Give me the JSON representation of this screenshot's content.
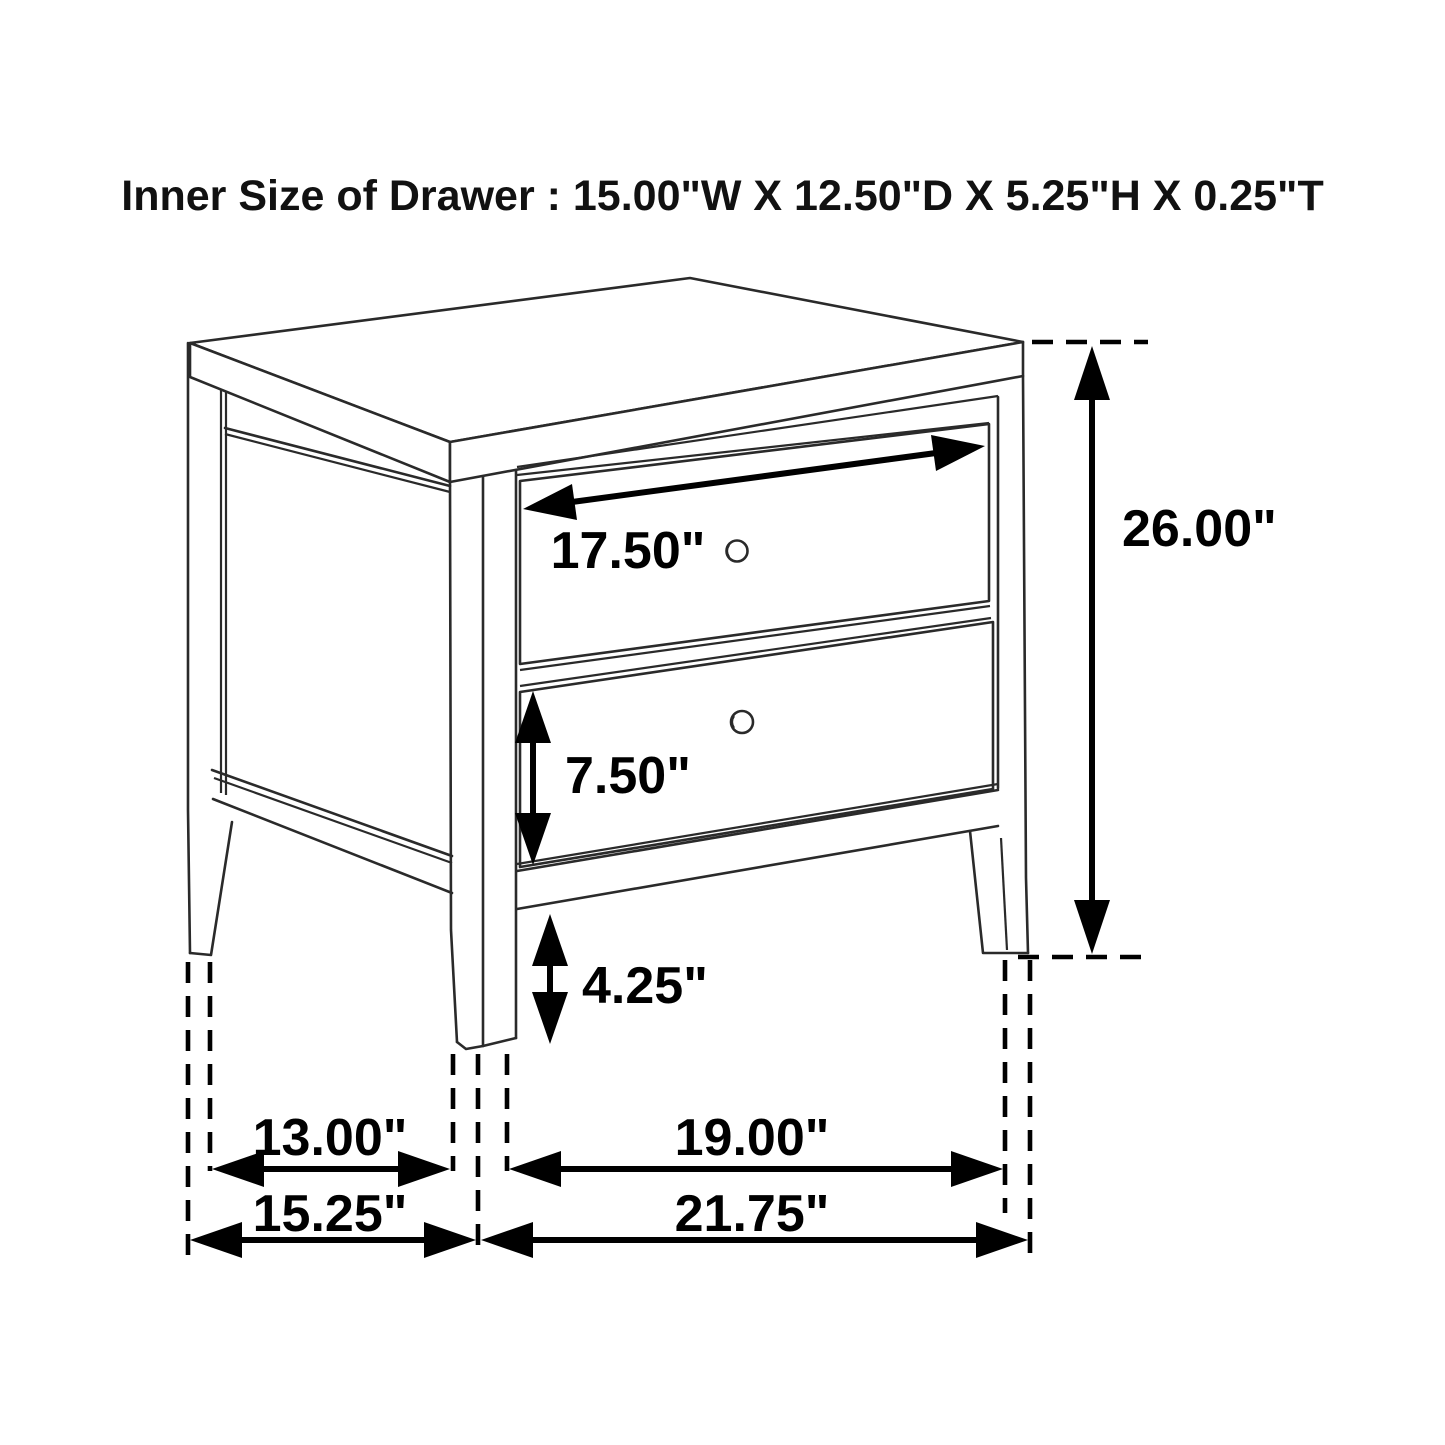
{
  "title": "Inner Size of Drawer : 15.00\"W X 12.50\"D X 5.25\"H X 0.25\"T",
  "dims": {
    "drawer_width": "17.50\"",
    "overall_height": "26.00\"",
    "drawer_height": "7.50\"",
    "bottom_clearance": "4.25\"",
    "side_leg_span": "13.00\"",
    "overall_depth": "15.25\"",
    "front_leg_span": "19.00\"",
    "overall_width": "21.75\""
  },
  "colors": {
    "background": "#ffffff",
    "furniture_line": "#2a2a2a",
    "dimension_line": "#000000",
    "text": "#111111"
  }
}
